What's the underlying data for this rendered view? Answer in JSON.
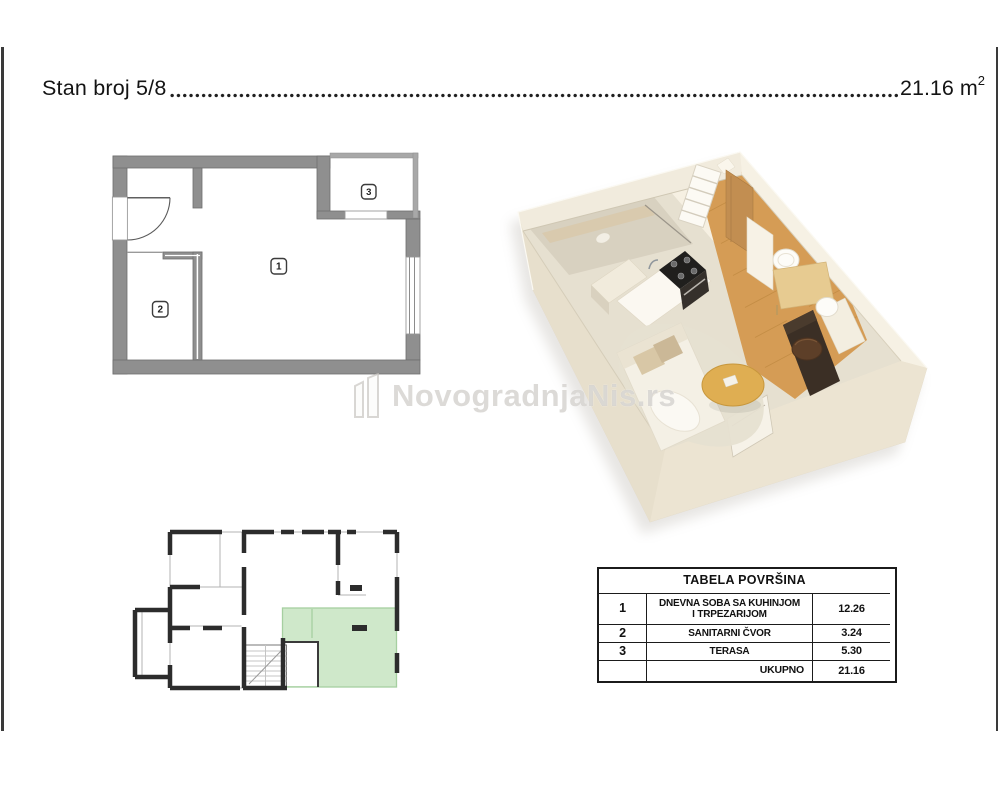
{
  "header": {
    "title": "Stan broj 5/8",
    "area_value": "21.16",
    "area_unit": "m",
    "area_sup": "2"
  },
  "floorplan_2d": {
    "room_labels": [
      "1",
      "2",
      "3"
    ]
  },
  "watermark": {
    "logo": "11",
    "text": "NovogradnjaNis.rs"
  },
  "area_table": {
    "title": "TABELA POVRŠINA",
    "rows": [
      {
        "num": "1",
        "name_line1": "DNEVNA SOBA SA KUHINJOM",
        "name_line2": "I TRPEZARIJOM",
        "value": "12.26"
      },
      {
        "num": "2",
        "name_line1": "SANITARNI ČVOR",
        "name_line2": "",
        "value": "3.24"
      },
      {
        "num": "3",
        "name_line1": "TERASA",
        "name_line2": "",
        "value": "5.30"
      }
    ],
    "total_label": "UKUPNO",
    "total_value": "21.16"
  },
  "colors": {
    "wall_gray": "#8f8f8f",
    "wall_edge": "#6e6e6e",
    "keyplan_black": "#2c2c2c",
    "highlight_green": "#cfe8ca",
    "render_cream": "#ede5d4",
    "render_wood": "#d59c55"
  }
}
